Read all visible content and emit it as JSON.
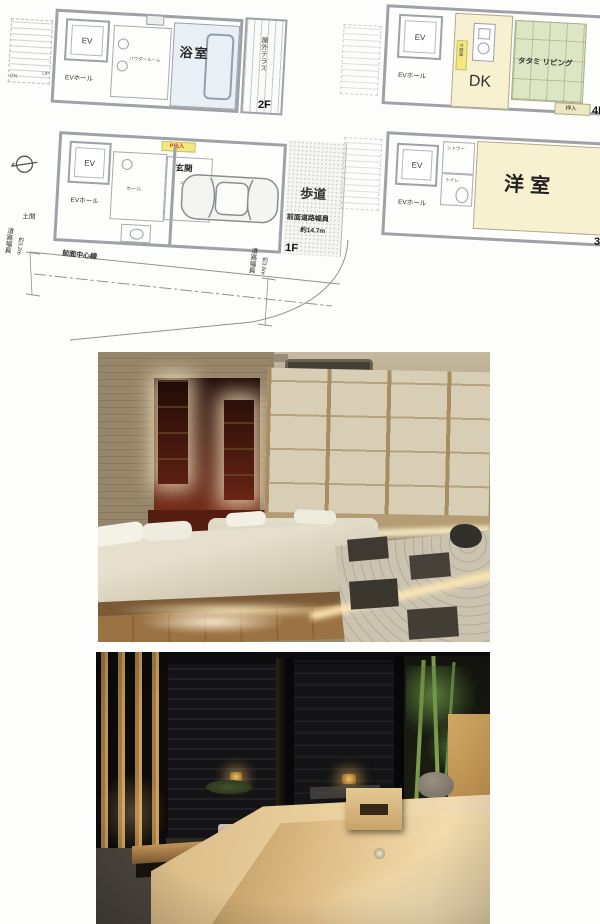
{
  "plans": {
    "f2": {
      "label": "2F",
      "ev": "EV",
      "ev_hall": "EVホール",
      "powder": "パウダールーム",
      "bath": "浴室",
      "terrace": "屋外テラス",
      "dn": "DN",
      "up": "UP"
    },
    "f4": {
      "label": "4F",
      "ev": "EV",
      "ev_hall": "EVホール",
      "dk": "DK",
      "tatami": "タタミ リビング",
      "closet": "押入",
      "fridge": "冷蔵庫"
    },
    "f1": {
      "label": "1F",
      "ev": "EV",
      "ev_hall": "EVホール",
      "doma": "土間",
      "hall": "ホール",
      "entrance": "玄関",
      "p_entry": "P出入",
      "cloak": "クローク",
      "sidewalk": "歩道",
      "front_road_label": "前面道路幅員",
      "front_road_value": "約14.7m",
      "center_line": "前面中心線",
      "left_road_label": "道路幅員",
      "left_road_value": "約3.2m",
      "right_road_label": "道路幅員",
      "right_road_value": "約3.6m"
    },
    "f3": {
      "label": "3F",
      "ev": "EV",
      "ev_hall": "EVホール",
      "shower": "シャワー",
      "toilet": "トイレ",
      "western": "洋室"
    }
  },
  "colors": {
    "tatami_green": "#dde6c4",
    "room_cream": "#f8f1cf",
    "bath_blue": "#e9eff4",
    "tag_yellow": "#f3e97e",
    "tag_red": "#c03a26",
    "wall_gray": "#9ea2a7"
  },
  "photos": {
    "bedroom": "japanese-bedroom-photo",
    "bath": "hinoki-bath-photo"
  }
}
